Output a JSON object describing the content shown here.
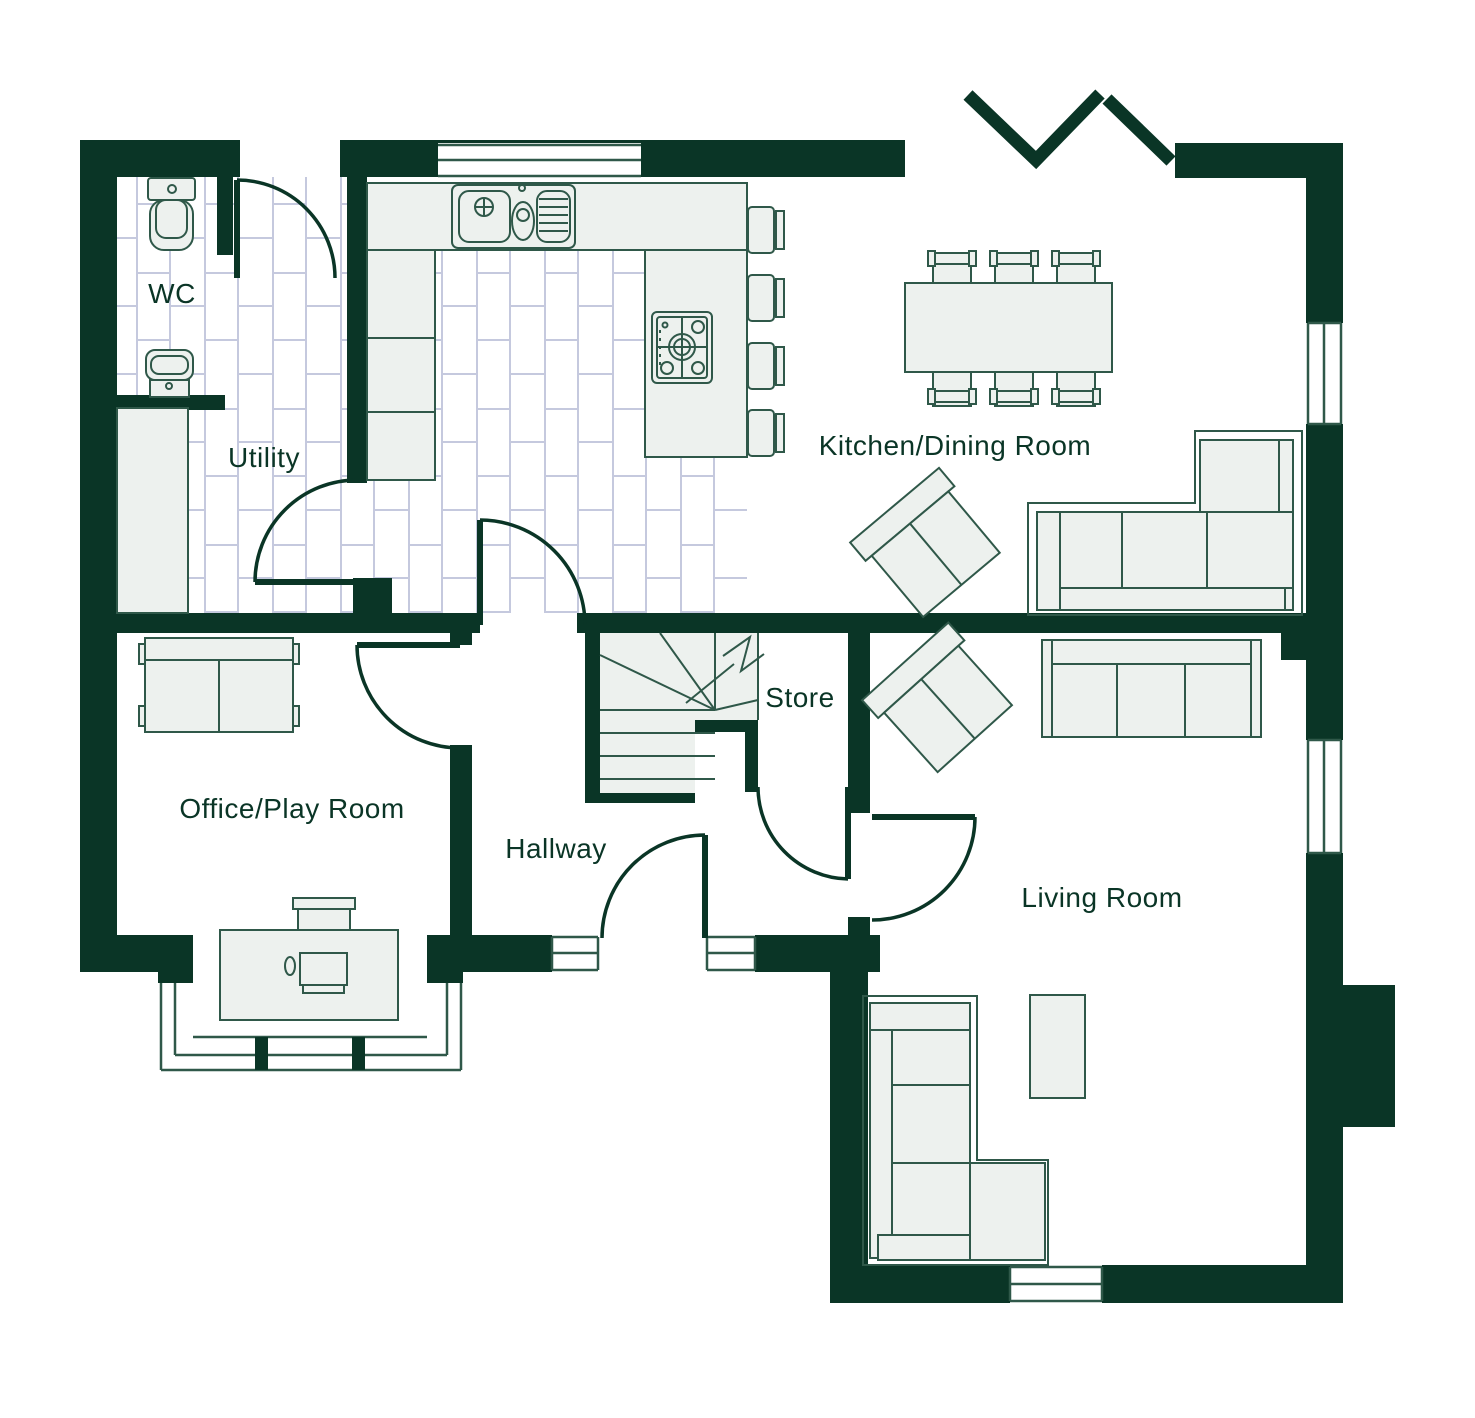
{
  "theme": {
    "wall": "#0a3526",
    "line": "#2f5849",
    "furn": "#edf1ee",
    "tile-line": "#c5c9de",
    "label": "#0a3526",
    "bg": "#ffffff"
  },
  "rooms": {
    "wc": {
      "label": "WC"
    },
    "utility": {
      "label": "Utility"
    },
    "kitchen_dining": {
      "label": "Kitchen/Dining Room"
    },
    "office": {
      "label": "Office/Play Room"
    },
    "hallway": {
      "label": "Hallway"
    },
    "store": {
      "label": "Store"
    },
    "living": {
      "label": "Living Room"
    }
  }
}
